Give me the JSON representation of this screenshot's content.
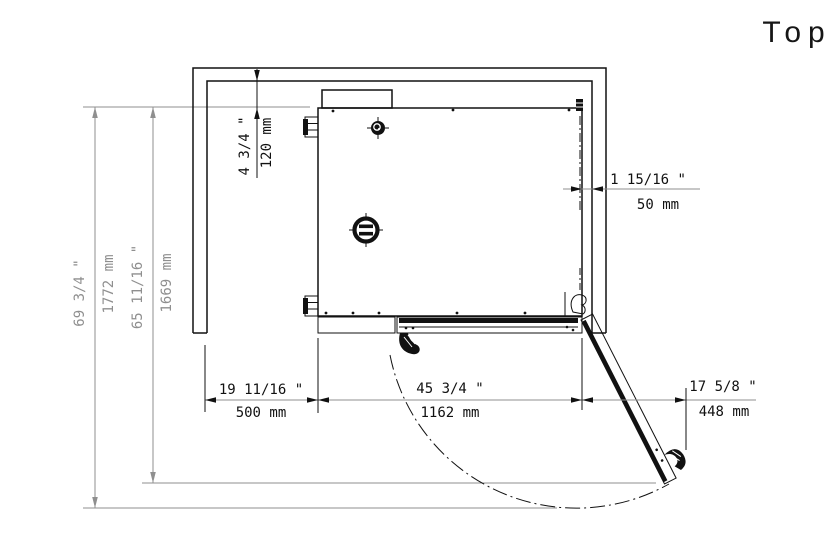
{
  "view_label": "Top",
  "dims": {
    "top_gap": {
      "inch": "4 3/4 \"",
      "mm": "120 mm"
    },
    "right_gap": {
      "inch": "1 15/16 \"",
      "mm": "50 mm"
    },
    "depth_total": {
      "inch": "69 3/4 \"",
      "mm": "1772 mm"
    },
    "depth_door_open": {
      "inch": "65 11/16 \"",
      "mm": "1669 mm"
    },
    "clearance_left": {
      "inch": "19 11/16 \"",
      "mm": "500 mm"
    },
    "unit_width": {
      "inch": "45 3/4 \"",
      "mm": "1162 mm"
    },
    "door_projection": {
      "inch": "17 5/8 \"",
      "mm": "448 mm"
    }
  },
  "colors": {
    "line": "#111111",
    "dim_gray": "#8f8f8f",
    "ext_gray": "#999999",
    "background": "#ffffff"
  }
}
